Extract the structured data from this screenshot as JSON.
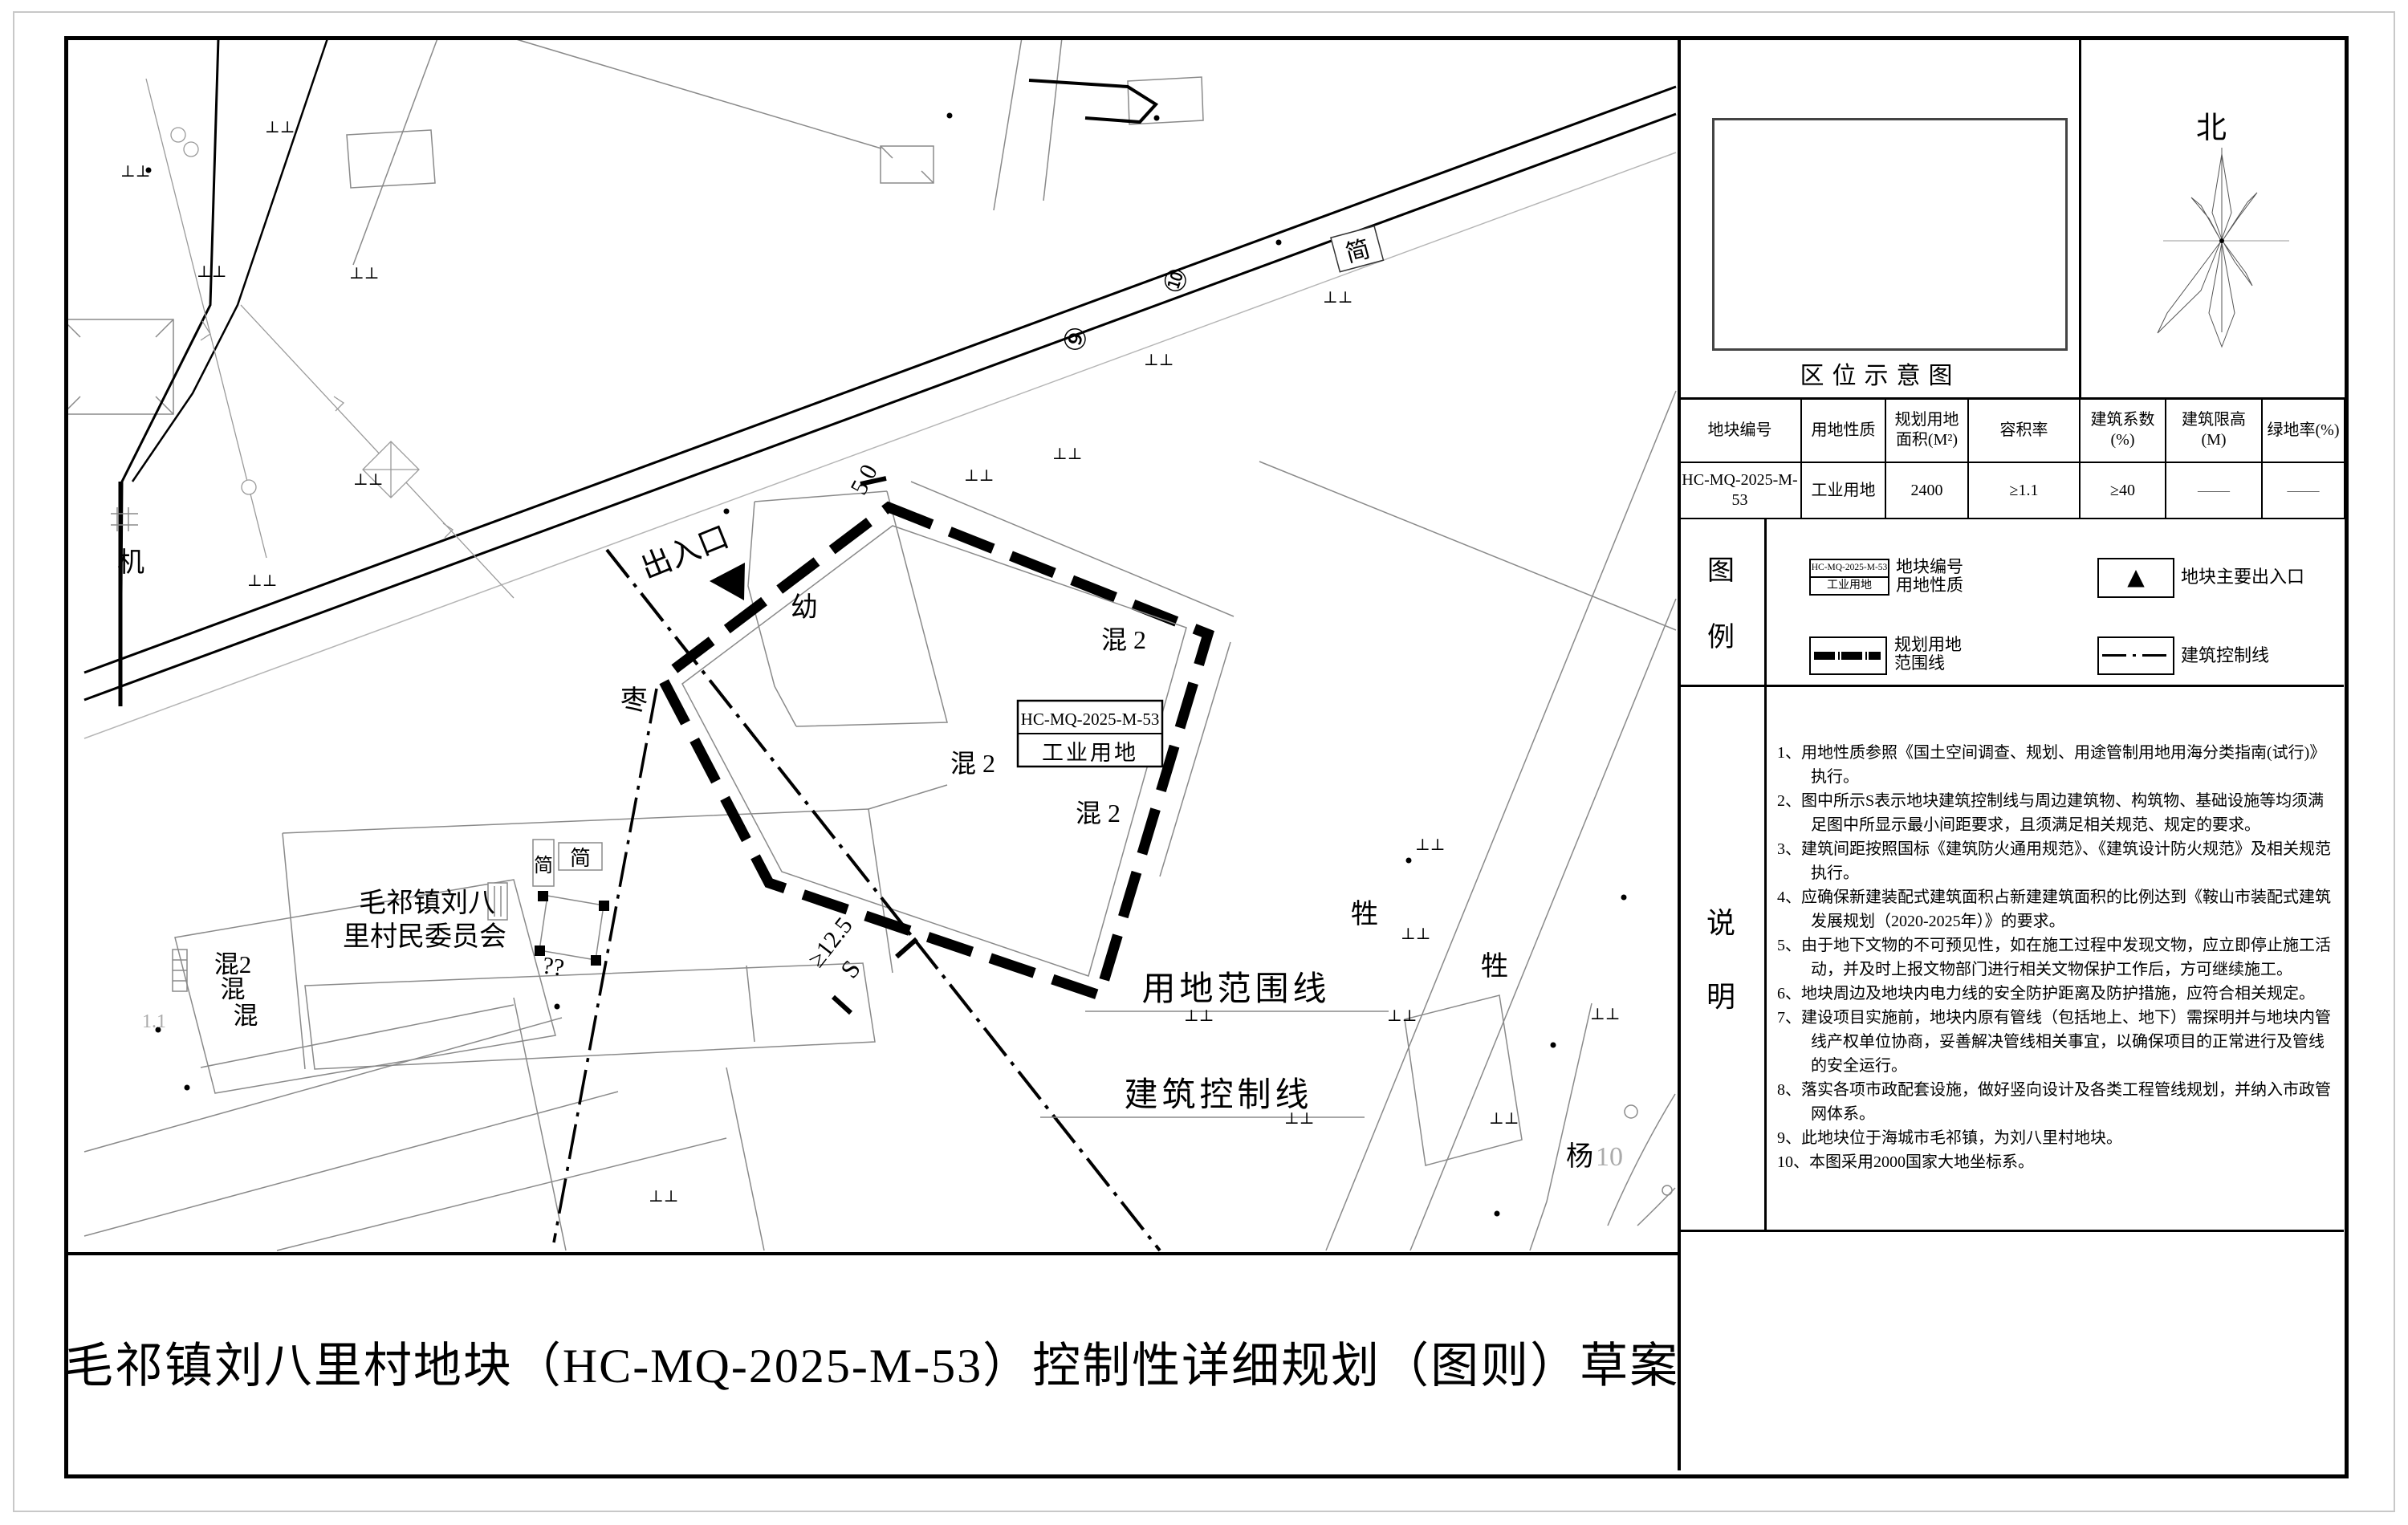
{
  "doc": {
    "title": "毛祁镇刘八里村地块（HC-MQ-2025-M-53）控制性详细规划（图则）草案"
  },
  "location_panel": {
    "caption": "区位示意图",
    "north_label": "北"
  },
  "table": {
    "headers": [
      [
        "地块编号"
      ],
      [
        "用地性质"
      ],
      [
        "规划用地",
        "面积(M²)"
      ],
      [
        "容积率"
      ],
      [
        "建筑系数",
        "(%)"
      ],
      [
        "建筑限高",
        "(M)"
      ],
      [
        "绿地率(%)"
      ]
    ],
    "row": [
      "HC-MQ-2025-M-53",
      "工业用地",
      "2400",
      "≥1.1",
      "≥40",
      "——",
      "——"
    ]
  },
  "legend": {
    "title_char1": "图",
    "title_char2": "例",
    "item1": {
      "box_top": "HC-MQ-2025-M-53",
      "box_bottom": "工业用地",
      "label_line1": "地块编号",
      "label_line2": "用地性质"
    },
    "item2": {
      "symbol": "▲",
      "label": "地块主要出入口"
    },
    "item3": {
      "label_line1": "规划用地",
      "label_line2": "范围线"
    },
    "item4": {
      "label": "建筑控制线"
    }
  },
  "notes": {
    "title_char1": "说",
    "title_char2": "明",
    "items": [
      "1、用地性质参照《国土空间调查、规划、用途管制用地用海分类指南(试行)》执行。",
      "2、图中所示S表示地块建筑控制线与周边建筑物、构筑物、基础设施等均须满足图中所显示最小间距要求，且须满足相关规范、规定的要求。",
      "3、建筑间距按照国标《建筑防火通用规范》、《建筑设计防火规范》及相关规范执行。",
      "4、应确保新建装配式建筑面积占新建建筑面积的比例达到《鞍山市装配式建筑发展规划（2020-2025年）》的要求。",
      "5、由于地下文物的不可预见性，如在施工过程中发现文物，应立即停止施工活动，并及时上报文物部门进行相关文物保护工作后，方可继续施工。",
      "6、地块周边及地块内电力线的安全防护距离及防护措施，应符合相关规定。",
      "7、建设项目实施前，地块内原有管线（包括地上、地下）需探明并与地块内管线产权单位协商，妥善解决管线相关事宜，以确保项目的正常进行及管线的安全运行。",
      "8、落实各项市政配套设施，做好竖向设计及各类工程管线规划，并纳入市政管网体系。",
      "9、此地块位于海城市毛祁镇，为刘八里村地块。",
      "10、本图采用2000国家大地坐标系。"
    ]
  },
  "map": {
    "entrance": "出入口",
    "block_box_line1": "HC-MQ-2025-M-53",
    "block_box_line2": "工业用地",
    "boundary_label": "用地范围线",
    "control_label": "建筑控制线",
    "committee_line1": "毛祁镇刘八",
    "committee_line2": "里村民委员会",
    "dim_50": "5.0",
    "dim_125": "≥12.5",
    "dim_s": "S",
    "kindergarten": "幼",
    "jujube": "枣",
    "mixed2": "混 2",
    "mixed2_tight": "混2",
    "mixed": "混",
    "val_11": "1.1",
    "livestock": "牲",
    "yang": "杨",
    "yang_num": "10",
    "machine": "机",
    "jian": "简",
    "unknown_marks": "??",
    "road_num_9": "⑨",
    "road_num_10": "⑩",
    "grass_symbol": "⊥⊥"
  }
}
